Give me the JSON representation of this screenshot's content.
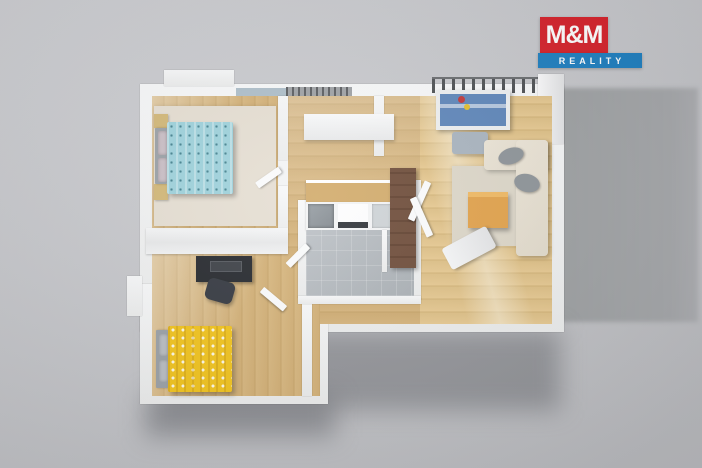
{
  "logo": {
    "brand_top": "M&M",
    "brand_bottom": "REALITY"
  },
  "colors": {
    "brand-red": "#d6222b",
    "brand-blue": "#1e7fc0",
    "background": "#c6c7cb",
    "cast-shadow": "#a0a2a5",
    "wall": "#f3f4f5",
    "wood-floor": "#d7b67e",
    "wood-floor-light": "#e3c48d",
    "bath-tile": "#b6bbc0",
    "bed-blue": "#9ed2dc",
    "bed-yellow": "#f2c41d",
    "sofa-cream": "#e9e2d4",
    "coffee-table-wood": "#e2a24b",
    "crib-blue": "#5e86ba",
    "desk-dark": "#25282d",
    "rug": "#e6dfd3"
  }
}
